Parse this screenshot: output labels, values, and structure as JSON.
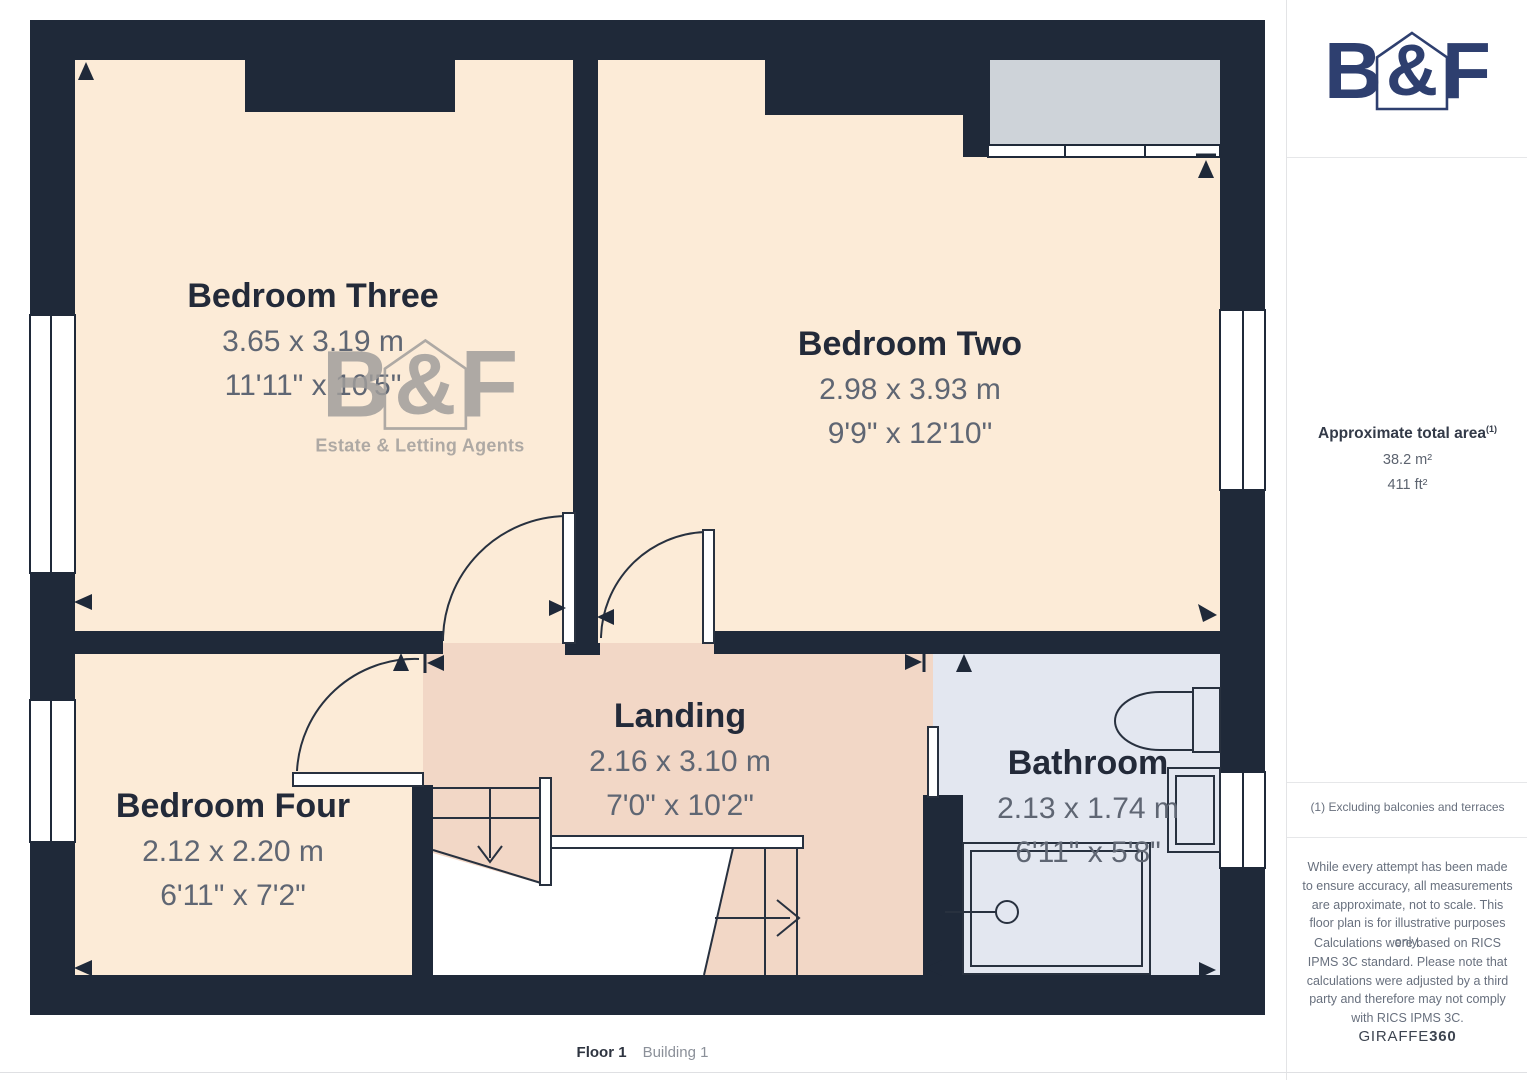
{
  "colors": {
    "brand_navy": "#2e3f6f",
    "wall": "#1f2939",
    "line": "#28313f",
    "bedroom_floor": "#fcebd7",
    "landing_floor": "#f2d7c6",
    "bathroom_floor": "#e3e7f0",
    "closet_gray": "#ced3d9",
    "room_name_text": "#232a39",
    "dimension_text": "#5f6673",
    "watermark_gray": "#a09d9b"
  },
  "brand": {
    "letter_b": "B",
    "ampersand": "&",
    "letter_f": "F",
    "tagline": "Estate & Letting Agents"
  },
  "plan": {
    "rooms": {
      "bedroom_three": {
        "name": "Bedroom Three",
        "metric": "3.65 x 3.19 m",
        "imperial": "11'11\" x 10'5\""
      },
      "bedroom_two": {
        "name": "Bedroom Two",
        "metric": "2.98 x 3.93 m",
        "imperial": "9'9\" x 12'10\""
      },
      "bedroom_four": {
        "name": "Bedroom Four",
        "metric": "2.12 x 2.20 m",
        "imperial": "6'11\" x 7'2\""
      },
      "landing": {
        "name": "Landing",
        "metric": "2.16 x 3.10 m",
        "imperial": "7'0\" x 10'2\""
      },
      "bathroom": {
        "name": "Bathroom",
        "metric": "2.13 x 1.74 m",
        "imperial": "6'11\" x 5'8\""
      }
    },
    "footer": {
      "floor": "Floor 1",
      "building": "Building 1"
    }
  },
  "sidebar": {
    "area": {
      "title": "Approximate total area",
      "footnote_marker": "(1)",
      "metric": "38.2 m²",
      "imperial": "411 ft²"
    },
    "footnote": "(1) Excluding balconies and terraces",
    "disclaimer_1": "While every attempt has been made to ensure accuracy, all measurements are approximate, not to scale. This floor plan is for illustrative purposes only.",
    "disclaimer_2": "Calculations were based on RICS IPMS 3C standard. Please note that calculations were adjusted by a third party and therefore may not comply with RICS IPMS 3C.",
    "brand_footer": {
      "name": "GIRAFFE",
      "suffix": "360"
    }
  }
}
